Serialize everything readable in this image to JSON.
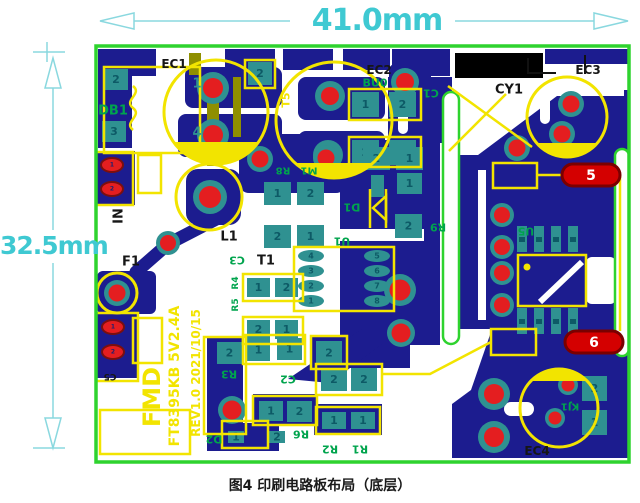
{
  "figure": {
    "caption": "图4 印刷电路板布局（底层）"
  },
  "dimensions": {
    "width_label": "41.0mm",
    "height_label": "32.5mm"
  },
  "silkscreen_text": {
    "brand": "FMD",
    "model": "FT8395KB 5V2.4A",
    "revision": "REV1.0 2021/10/15"
  },
  "colors": {
    "board_outline": "#2ed32e",
    "copper": "#1c1c8f",
    "pad_teal": "#2f9191",
    "pad_number": "#0d5a66",
    "hole_red": "#e41e20",
    "stadium_red": "#d40000",
    "stadium_border": "#7a0000",
    "silkscreen_yellow": "#f2e400",
    "label_green": "#00a44d",
    "label_black": "#161616",
    "dimension_cyan": "#3fc9d2",
    "olive": "#8f8f00",
    "white": "#ffffff"
  },
  "labels": [
    {
      "name": "ec1-label",
      "t": "EC1",
      "x": 174,
      "y": 64,
      "f": "black",
      "s": 12
    },
    {
      "name": "db1-label",
      "t": "DB1",
      "x": 113,
      "y": 111,
      "f": "green",
      "s": 13
    },
    {
      "name": "ec2-label",
      "t": "EC2",
      "x": 379,
      "y": 70,
      "f": "black",
      "s": 12
    },
    {
      "name": "bu0-label",
      "t": "BU0",
      "x": 375,
      "y": 83,
      "f": "green",
      "s": 11
    },
    {
      "name": "c1-label",
      "t": "C1",
      "x": 431,
      "y": 93,
      "f": "green",
      "s": 11,
      "r": 180
    },
    {
      "name": "cy1-label",
      "t": "CY1",
      "x": 509,
      "y": 90,
      "f": "black",
      "s": 13
    },
    {
      "name": "ec3-label",
      "t": "EC3",
      "x": 588,
      "y": 70,
      "f": "black",
      "s": 12
    },
    {
      "name": "t5-label",
      "t": "T5",
      "x": 286,
      "y": 100,
      "f": "yellow",
      "s": 11,
      "r": -90
    },
    {
      "name": "in-label",
      "t": "IN",
      "x": 119,
      "y": 216,
      "f": "black",
      "s": 13,
      "r": -90
    },
    {
      "name": "f1-label",
      "t": "F1",
      "x": 131,
      "y": 262,
      "f": "black",
      "s": 13
    },
    {
      "name": "l1-label",
      "t": "L1",
      "x": 229,
      "y": 237,
      "f": "black",
      "s": 13
    },
    {
      "name": "r8-label",
      "t": "R8",
      "x": 283,
      "y": 170,
      "f": "green",
      "s": 10,
      "r": 180
    },
    {
      "name": "m1-label",
      "t": "M1",
      "x": 309,
      "y": 170,
      "f": "green",
      "s": 10,
      "r": 180
    },
    {
      "name": "d1-label",
      "t": "D1",
      "x": 352,
      "y": 207,
      "f": "green",
      "s": 11,
      "r": 180
    },
    {
      "name": "r9-label",
      "t": "R9",
      "x": 438,
      "y": 227,
      "f": "green",
      "s": 11,
      "r": 180
    },
    {
      "name": "u1-label",
      "t": "U1",
      "x": 342,
      "y": 241,
      "f": "green",
      "s": 11,
      "r": 180
    },
    {
      "name": "c3-label",
      "t": "C3",
      "x": 237,
      "y": 260,
      "f": "green",
      "s": 11,
      "r": 180
    },
    {
      "name": "t1-label",
      "t": "T1",
      "x": 266,
      "y": 261,
      "f": "black",
      "s": 13
    },
    {
      "name": "r4-label",
      "t": "R4",
      "x": 236,
      "y": 283,
      "f": "green",
      "s": 9,
      "r": -90
    },
    {
      "name": "r5-label",
      "t": "R5",
      "x": 236,
      "y": 305,
      "f": "green",
      "s": 9,
      "r": -90
    },
    {
      "name": "r3-label",
      "t": "R3",
      "x": 229,
      "y": 374,
      "f": "green",
      "s": 11,
      "r": 180
    },
    {
      "name": "c2-label",
      "t": "C2",
      "x": 288,
      "y": 379,
      "f": "green",
      "s": 11,
      "r": 180
    },
    {
      "name": "r6-label",
      "t": "R6",
      "x": 301,
      "y": 434,
      "f": "green",
      "s": 11,
      "r": 180
    },
    {
      "name": "r2-label",
      "t": "R2",
      "x": 330,
      "y": 449,
      "f": "green",
      "s": 11,
      "r": 180
    },
    {
      "name": "r1-label",
      "t": "R1",
      "x": 360,
      "y": 449,
      "f": "green",
      "s": 11,
      "r": 180
    },
    {
      "name": "d2-label",
      "t": "D2",
      "x": 214,
      "y": 439,
      "f": "green",
      "s": 11,
      "r": 180
    },
    {
      "name": "u5-label",
      "t": "U5",
      "x": 526,
      "y": 231,
      "f": "green",
      "s": 11,
      "r": 180
    },
    {
      "name": "kj1-label",
      "t": "KJ1",
      "x": 570,
      "y": 406,
      "f": "green",
      "s": 10,
      "r": 180
    },
    {
      "name": "ec4-label",
      "t": "EC4",
      "x": 537,
      "y": 451,
      "f": "black",
      "s": 12
    },
    {
      "name": "c5-label",
      "t": "C5",
      "x": 110,
      "y": 376,
      "f": "black",
      "s": 9,
      "r": 180
    },
    {
      "name": "brand-text",
      "t": "FMD",
      "x": 152,
      "y": 397,
      "f": "yellow",
      "s": 24,
      "r": -90
    },
    {
      "name": "model-text",
      "t": "FT8395KB 5V2.4A",
      "x": 175,
      "y": 376,
      "f": "yellow",
      "s": 14,
      "r": -90
    },
    {
      "name": "revision-text",
      "t": "REV1.0 2021/10/15",
      "x": 196,
      "y": 373,
      "f": "yellow",
      "s": 12,
      "r": -90
    },
    {
      "name": "pad5-number",
      "t": "5",
      "x": 591,
      "y": 176,
      "f": "white",
      "s": 14
    },
    {
      "name": "pad6-number",
      "t": "6",
      "x": 594,
      "y": 343,
      "f": "white",
      "s": 14
    },
    {
      "name": "ec1-pin1",
      "t": "1",
      "x": 197,
      "y": 84,
      "f": "teal",
      "s": 13
    },
    {
      "name": "ec1-pin4",
      "t": "4",
      "x": 197,
      "y": 133,
      "f": "teal",
      "s": 13
    }
  ],
  "square_pads": [
    {
      "x": 104,
      "y": 69,
      "w": 24,
      "h": 21,
      "n": "2"
    },
    {
      "x": 102,
      "y": 121,
      "w": 24,
      "h": 21,
      "n": "3"
    },
    {
      "x": 248,
      "y": 62,
      "w": 24,
      "h": 23,
      "n": "2"
    },
    {
      "x": 352,
      "y": 92,
      "w": 27,
      "h": 25,
      "n": "1"
    },
    {
      "x": 389,
      "y": 92,
      "w": 27,
      "h": 25,
      "n": "2"
    },
    {
      "x": 352,
      "y": 140,
      "w": 27,
      "h": 25,
      "n": "2"
    },
    {
      "x": 389,
      "y": 140,
      "w": 27,
      "h": 25,
      "n": "1"
    },
    {
      "x": 264,
      "y": 182,
      "w": 27,
      "h": 23,
      "n": "1"
    },
    {
      "x": 297,
      "y": 182,
      "w": 27,
      "h": 23,
      "n": "2"
    },
    {
      "x": 264,
      "y": 225,
      "w": 27,
      "h": 23,
      "n": "2"
    },
    {
      "x": 297,
      "y": 225,
      "w": 27,
      "h": 23,
      "n": "1"
    },
    {
      "x": 363,
      "y": 147,
      "w": 27,
      "h": 23,
      "n": "2"
    },
    {
      "x": 396,
      "y": 147,
      "w": 27,
      "h": 23,
      "n": "1"
    },
    {
      "x": 397,
      "y": 173,
      "w": 25,
      "h": 21,
      "n": "1"
    },
    {
      "x": 395,
      "y": 214,
      "w": 27,
      "h": 24,
      "n": "2"
    },
    {
      "x": 371,
      "y": 175,
      "w": 13,
      "h": 22,
      "n": ""
    },
    {
      "x": 247,
      "y": 278,
      "w": 23,
      "h": 19,
      "n": "1"
    },
    {
      "x": 275,
      "y": 278,
      "w": 23,
      "h": 19,
      "n": "2"
    },
    {
      "x": 247,
      "y": 320,
      "w": 23,
      "h": 19,
      "n": "2"
    },
    {
      "x": 275,
      "y": 320,
      "w": 23,
      "h": 19,
      "n": "1"
    },
    {
      "x": 217,
      "y": 342,
      "w": 25,
      "h": 22,
      "n": "2"
    },
    {
      "x": 247,
      "y": 339,
      "w": 23,
      "h": 22,
      "n": "1"
    },
    {
      "x": 277,
      "y": 338,
      "w": 25,
      "h": 22,
      "n": "1"
    },
    {
      "x": 316,
      "y": 341,
      "w": 26,
      "h": 24,
      "n": "2"
    },
    {
      "x": 321,
      "y": 368,
      "w": 26,
      "h": 23,
      "n": "2"
    },
    {
      "x": 351,
      "y": 368,
      "w": 26,
      "h": 23,
      "n": "2"
    },
    {
      "x": 259,
      "y": 401,
      "w": 24,
      "h": 20,
      "n": "1"
    },
    {
      "x": 287,
      "y": 401,
      "w": 25,
      "h": 21,
      "n": "2"
    },
    {
      "x": 322,
      "y": 412,
      "w": 24,
      "h": 17,
      "n": "1"
    },
    {
      "x": 351,
      "y": 412,
      "w": 24,
      "h": 17,
      "n": "1"
    },
    {
      "x": 228,
      "y": 431,
      "w": 16,
      "h": 12,
      "n": "1"
    },
    {
      "x": 269,
      "y": 431,
      "w": 16,
      "h": 12,
      "n": "2"
    },
    {
      "x": 582,
      "y": 376,
      "w": 25,
      "h": 25,
      "n": "2"
    },
    {
      "x": 582,
      "y": 410,
      "w": 25,
      "h": 25,
      "n": "1"
    }
  ],
  "round_pads": [
    {
      "x": 213,
      "y": 88,
      "r1": 16,
      "r2": 10
    },
    {
      "x": 213,
      "y": 135,
      "r1": 16,
      "r2": 10
    },
    {
      "x": 330,
      "y": 96,
      "r1": 15,
      "r2": 9
    },
    {
      "x": 328,
      "y": 155,
      "r1": 15,
      "r2": 9
    },
    {
      "x": 405,
      "y": 82,
      "r1": 14,
      "r2": 9
    },
    {
      "x": 260,
      "y": 159,
      "r1": 13,
      "r2": 8.5
    },
    {
      "x": 326,
      "y": 158,
      "r1": 13,
      "r2": 8.5
    },
    {
      "x": 210,
      "y": 197,
      "r1": 17,
      "r2": 11
    },
    {
      "x": 168,
      "y": 243,
      "r1": 12,
      "r2": 8
    },
    {
      "x": 117,
      "y": 293,
      "r1": 13,
      "r2": 8.5
    },
    {
      "x": 571,
      "y": 104,
      "r1": 13,
      "r2": 8.5
    },
    {
      "x": 562,
      "y": 134,
      "r1": 13,
      "r2": 8.5
    },
    {
      "x": 517,
      "y": 148,
      "r1": 13,
      "r2": 8.5
    },
    {
      "x": 400,
      "y": 290,
      "r1": 16,
      "r2": 10.5
    },
    {
      "x": 401,
      "y": 333,
      "r1": 14,
      "r2": 9.5
    },
    {
      "x": 502,
      "y": 215,
      "r1": 12,
      "r2": 8
    },
    {
      "x": 502,
      "y": 247,
      "r1": 12,
      "r2": 8
    },
    {
      "x": 502,
      "y": 273,
      "r1": 12,
      "r2": 8
    },
    {
      "x": 502,
      "y": 305,
      "r1": 12,
      "r2": 8
    },
    {
      "x": 232,
      "y": 410,
      "r1": 14,
      "r2": 9.5
    },
    {
      "x": 494,
      "y": 394,
      "r1": 16,
      "r2": 10
    },
    {
      "x": 494,
      "y": 437,
      "r1": 16,
      "r2": 10
    },
    {
      "x": 568,
      "y": 385,
      "r1": 10,
      "r2": 6.5
    },
    {
      "x": 555,
      "y": 418,
      "r1": 10,
      "r2": 6.5
    }
  ],
  "oval_pads": [
    {
      "x": 112,
      "y": 165,
      "rx": 11,
      "ry": 7,
      "fill": "red",
      "n": "1"
    },
    {
      "x": 112,
      "y": 189,
      "rx": 11,
      "ry": 7,
      "fill": "red",
      "n": "2"
    },
    {
      "x": 113,
      "y": 327,
      "rx": 11,
      "ry": 7,
      "fill": "red",
      "n": "1"
    },
    {
      "x": 113,
      "y": 352,
      "rx": 11,
      "ry": 7,
      "fill": "red",
      "n": "2"
    },
    {
      "x": 311,
      "y": 256,
      "rx": 13,
      "ry": 6,
      "fill": "teal",
      "n": "4"
    },
    {
      "x": 311,
      "y": 271,
      "rx": 13,
      "ry": 6,
      "fill": "teal",
      "n": "3"
    },
    {
      "x": 311,
      "y": 286,
      "rx": 13,
      "ry": 6,
      "fill": "teal",
      "n": "2"
    },
    {
      "x": 311,
      "y": 301,
      "rx": 13,
      "ry": 6,
      "fill": "teal",
      "n": "1"
    },
    {
      "x": 377,
      "y": 256,
      "rx": 13,
      "ry": 6,
      "fill": "teal",
      "n": "5"
    },
    {
      "x": 377,
      "y": 271,
      "rx": 13,
      "ry": 6,
      "fill": "teal",
      "n": "6"
    },
    {
      "x": 377,
      "y": 286,
      "rx": 13,
      "ry": 6,
      "fill": "teal",
      "n": "7"
    },
    {
      "x": 377,
      "y": 301,
      "rx": 13,
      "ry": 6,
      "fill": "teal",
      "n": "8"
    }
  ],
  "ic_bars": [
    {
      "x": 517,
      "y": 226
    },
    {
      "x": 534,
      "y": 226
    },
    {
      "x": 551,
      "y": 226
    },
    {
      "x": 568,
      "y": 226
    },
    {
      "x": 517,
      "y": 308
    },
    {
      "x": 534,
      "y": 308
    },
    {
      "x": 551,
      "y": 308
    },
    {
      "x": 568,
      "y": 308
    }
  ],
  "stadium_pads": [
    {
      "name": "output-pad-5",
      "x": 562,
      "y": 164,
      "w": 58,
      "h": 22
    },
    {
      "name": "output-pad-6",
      "x": 565,
      "y": 331,
      "w": 58,
      "h": 22
    }
  ]
}
